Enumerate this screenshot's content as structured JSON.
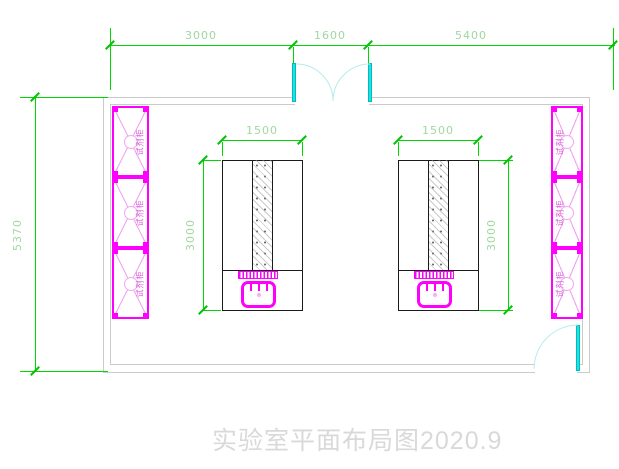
{
  "drawing": {
    "title": "实验室平面布局图2020.9",
    "dimensions": {
      "top_left": "3000",
      "top_middle": "1600",
      "top_right": "5400",
      "left_overall": "5370",
      "bench_width": "1500",
      "bench_depth": "3000"
    },
    "cabinet_label": "试剂柜",
    "colors": {
      "dimension_line": "#00d600",
      "dimension_text": "#9fd89f",
      "wall": "#cbcbcb",
      "door_leaf": "#1fe2e2",
      "door_arc": "#b5eded",
      "furniture": "#ff00ff",
      "bench_outline": "#1a1a1a",
      "title_text": "#d9d9d9"
    }
  }
}
